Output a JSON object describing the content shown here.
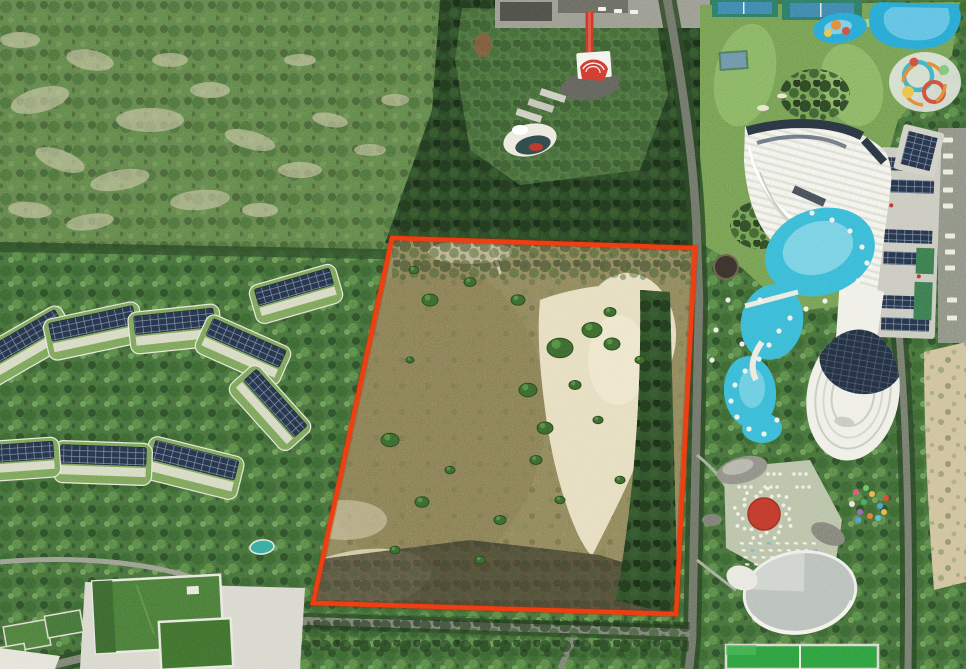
{
  "photo": {
    "kind": "aerial-drone-photo",
    "width": 966,
    "height": 669
  },
  "boundary": {
    "points": "392,238 695,248 676,614 313,603",
    "stroke_width": 4.5
  },
  "colors": {
    "boundary_red": "#ee3a10",
    "boundary_red_dark": "#a82807",
    "palm_green": "#47703c",
    "hillside_green": "#64834c",
    "hill_sand": "#d6cdad",
    "conifer_green": "#2c4727",
    "garden_green": "#4e7340",
    "golf_green": "#759e53",
    "fairway_light": "#8cb968",
    "lot_dirt": "#8f855c",
    "lot_sand": "#e6ddbf",
    "scorched_dark": "#4f4636",
    "resort_roof_green": "#7ba35b",
    "turf_roof_green": "#4a7b39",
    "solar_navy": "#26344a",
    "hotel_white": "#f0f0e9",
    "wing_gray": "#c9c9c0",
    "road_gray": "#7c8174",
    "pool_turquoise": "#3bb9d6",
    "pool_light": "#82d4e4",
    "water_blue": "#2aa7d3",
    "plaza_sage": "#b9c2a8",
    "stage_red": "#bf3a2c",
    "carpet_red": "#c23b2a",
    "chapel_red": "#cf3b30",
    "dome_gray": "#b9bfba",
    "court_green": "#2f9e3f",
    "sand_strip": "#cfc19c",
    "pavement_gray": "#9a9a90",
    "plaza_dark": "#62625c"
  }
}
